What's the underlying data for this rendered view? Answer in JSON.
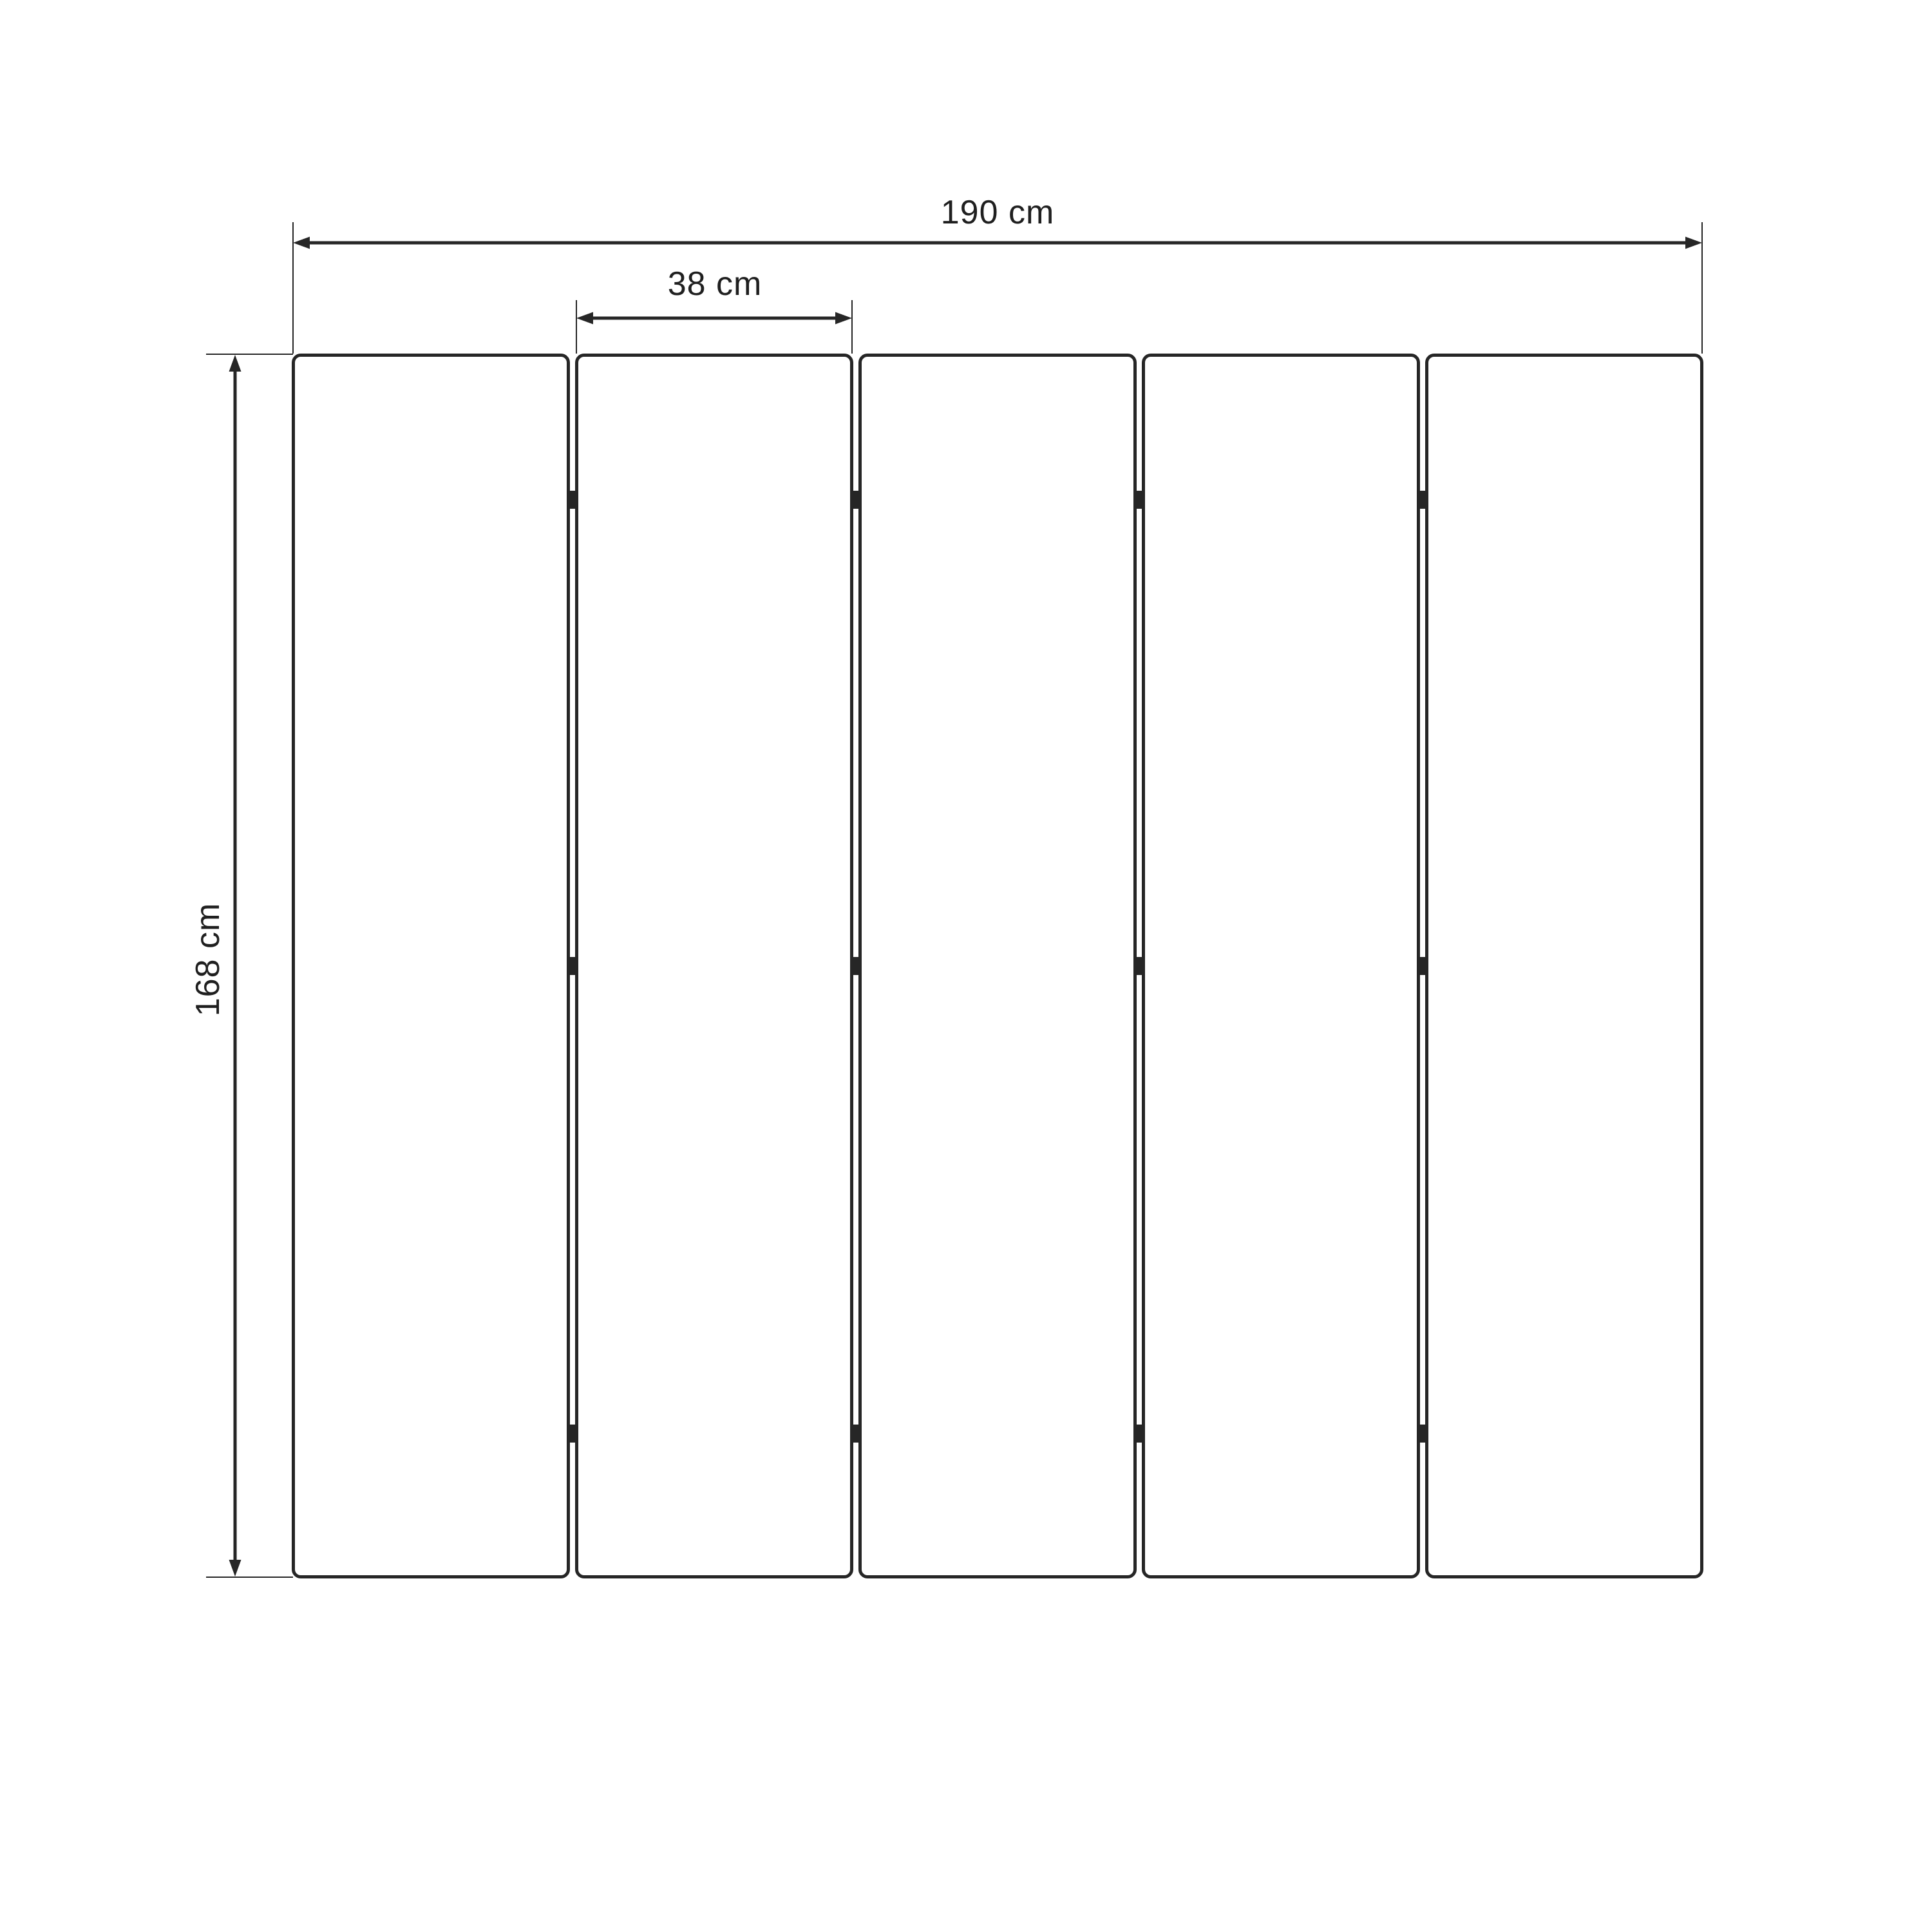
{
  "figure": {
    "type": "technical-dimension-diagram",
    "subject": "five-panel folding screen / room divider, front elevation",
    "background_color": "#ffffff",
    "line_color": "#262626",
    "text_color": "#1f1f1f",
    "panel_count": 5,
    "joint_count": 4,
    "hinges_per_joint": 3
  },
  "dimensions": {
    "total_width": {
      "label": "190 cm",
      "value": 190,
      "unit": "cm"
    },
    "panel_width": {
      "label": "38 cm",
      "value": 38,
      "unit": "cm"
    },
    "height": {
      "label": "168 cm",
      "value": 168,
      "unit": "cm"
    }
  }
}
